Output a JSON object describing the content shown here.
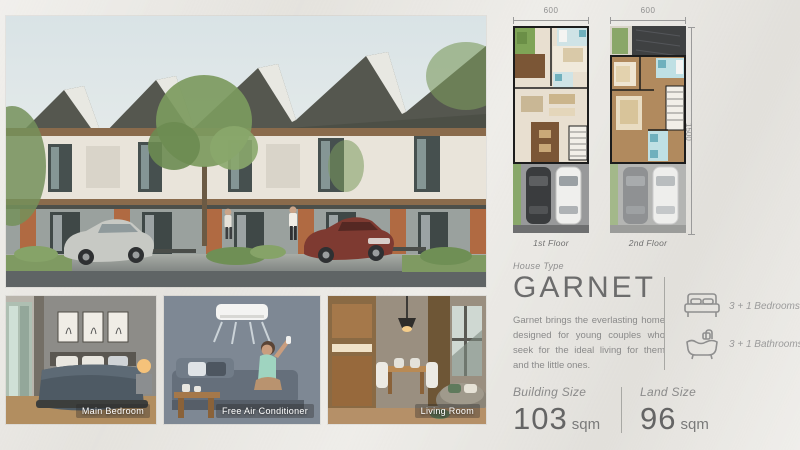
{
  "photos": [
    {
      "caption": "Main Bedroom"
    },
    {
      "caption": "Free Air Conditioner"
    },
    {
      "caption": "Living Room"
    }
  ],
  "floorplans": {
    "first": {
      "width_label": "600",
      "floor_label": "1st Floor"
    },
    "second": {
      "width_label": "600",
      "floor_label": "2nd Floor"
    },
    "height_label": "1500"
  },
  "house": {
    "type_label": "House Type",
    "name": "GARNET",
    "description": "Garnet brings the everlasting home designed for young couples who seek for the ideal living for them and the little ones."
  },
  "features": {
    "bedrooms": {
      "icon": "double-bed-icon",
      "label": "3 + 1 Bedrooms"
    },
    "bathrooms": {
      "icon": "bathtub-icon",
      "label": "3 + 1 Bathrooms"
    }
  },
  "sizes": {
    "building": {
      "label": "Building Size",
      "value": "103",
      "unit": "sqm"
    },
    "land": {
      "label": "Land Size",
      "value": "96",
      "unit": "sqm"
    }
  },
  "colors": {
    "background": "#e9e7e2",
    "text_dark": "#6c6c6c",
    "text_muted": "#8f8f8f",
    "brick": "#b06a42",
    "roof": "#53554f"
  }
}
